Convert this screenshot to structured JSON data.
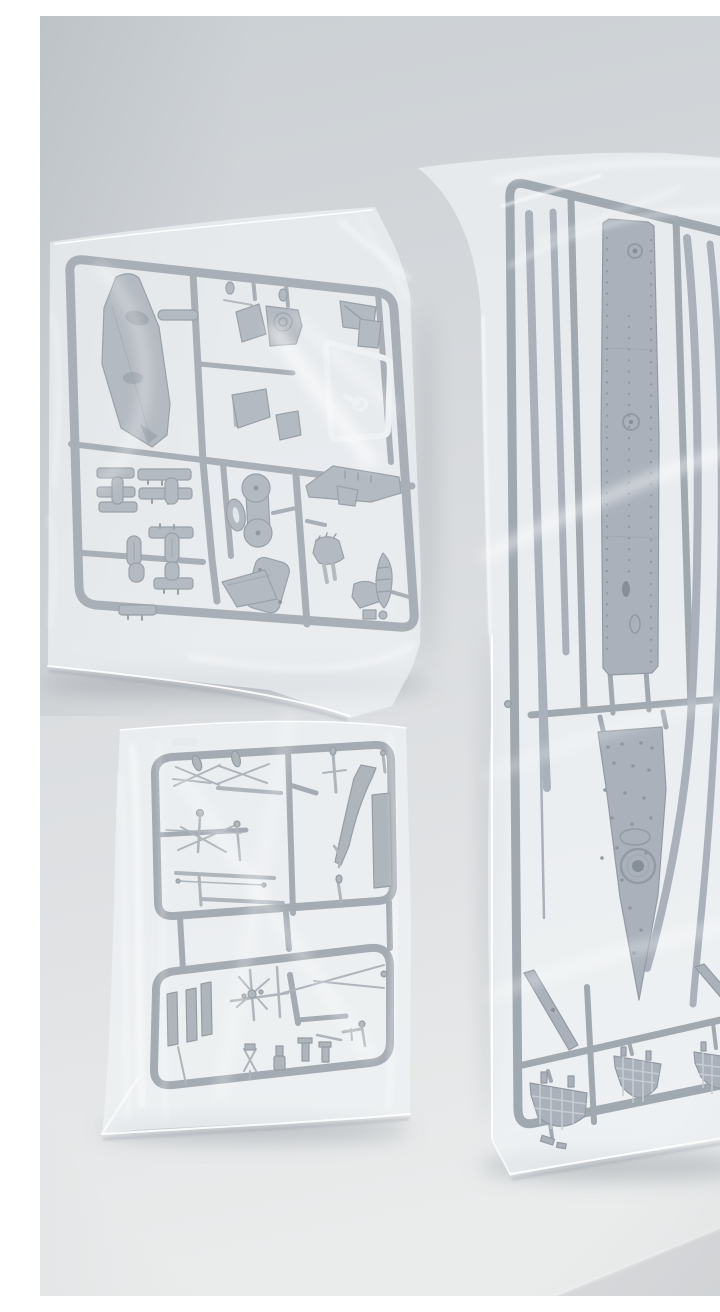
{
  "scene": {
    "description": "Top-down photograph of a scale model kit's contents: three clear polyethylene bags holding grey injection-moulded sprues of warship parts, lying on a pale grey surface",
    "background": "plain light grey backdrop, brighter toward the bottom of the frame, faint wall seam at upper right",
    "bags": [
      {
        "id": "bag-superstructure-parts",
        "position": "upper left",
        "contents": "square sprue with a long superstructure deck, bridge blocks, funnel, twin round gun platforms, turrets, ship's boats, railing strips and a small clear-parts sprue"
      },
      {
        "id": "bag-mast-parts",
        "position": "lower left",
        "contents": "double rectangular sprue of masts, yardarms, crosstrees, booms, davits, searchlights and other thin fittings"
      },
      {
        "id": "bag-hull-parts",
        "position": "right, standing tall",
        "contents": "tall sprue with two long deck sections (one with a pointed bow), four long hull-side strips and three latticed hull gratings at the bottom"
      }
    ],
    "materials": {
      "plastic": "medium grey styrene",
      "clear_part": "transparent styrene",
      "bag": "glossy translucent film with creases and highlights"
    }
  },
  "colors": {
    "wall_top": "#cbd0d4",
    "wall_upper": "#d6d9dc",
    "wall_lower": "#e0e2e4",
    "wall_bottom": "#eaecec",
    "corner_line": "rgba(120,128,136,0.30)",
    "floor_edge_band": "#d3d6d8",
    "bag_film": "rgba(244,247,249,0.52)",
    "bag_film_over": "rgba(238,242,245,0.30)",
    "bag_edge": "rgba(255,255,255,0.90)",
    "bag_crease": "rgba(255,255,255,0.60)",
    "bag_crease_soft": "rgba(255,255,255,0.40)",
    "bag_fold_shadow": "rgba(148,156,163,0.35)",
    "bag_shadow": "rgba(128,137,145,0.38)",
    "runner_a": "#8a929b",
    "plastic_a": "#9ba3ab",
    "plastic_a_dark": "#747e88",
    "runner_b": "#7e8893",
    "plastic_b": "#8d96a2",
    "plastic_b_dark": "#6a7480",
    "runner_c": "#848d95",
    "plastic_c": "#939ba3",
    "plastic_c_dark": "#6f7982",
    "clear_part": "#eef1f3",
    "clear_inner": "#dde2e6",
    "hole_dark": "#596470",
    "grate_line": "#b5bcc3",
    "deck_detail": "#66707c"
  }
}
